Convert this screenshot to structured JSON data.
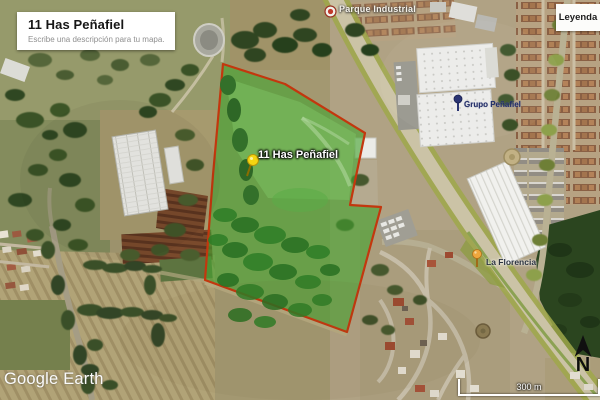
{
  "title_box": {
    "title": "11 Has Peñafiel",
    "description_placeholder": "Escribe una descripción para tu mapa."
  },
  "legend": {
    "label": "Leyenda"
  },
  "branding": {
    "watermark": "Google Earth"
  },
  "scale": {
    "label": "300 m"
  },
  "compass": {
    "label": "N"
  },
  "placemarks": {
    "parcel": {
      "label": "11 Has Peñafiel",
      "pin": "yellow-pushpin",
      "area_fill": "#46a331",
      "outline_color": "#c3370e"
    },
    "grupo_penafiel": {
      "label": "Grupo Peñafiel",
      "pin": "blue-marker",
      "color": "#222d66"
    },
    "la_florencia": {
      "label": "La Florencia",
      "pin": "orange-marker",
      "color": "#e79b36"
    },
    "road": {
      "label": "Parque Industrial",
      "pin": "road-shield"
    }
  },
  "map_colors": {
    "farmland": "#a39871",
    "highway": "#cbc3a6",
    "highway_verge": "#9fa84a",
    "dark_field": "#2b451f"
  }
}
